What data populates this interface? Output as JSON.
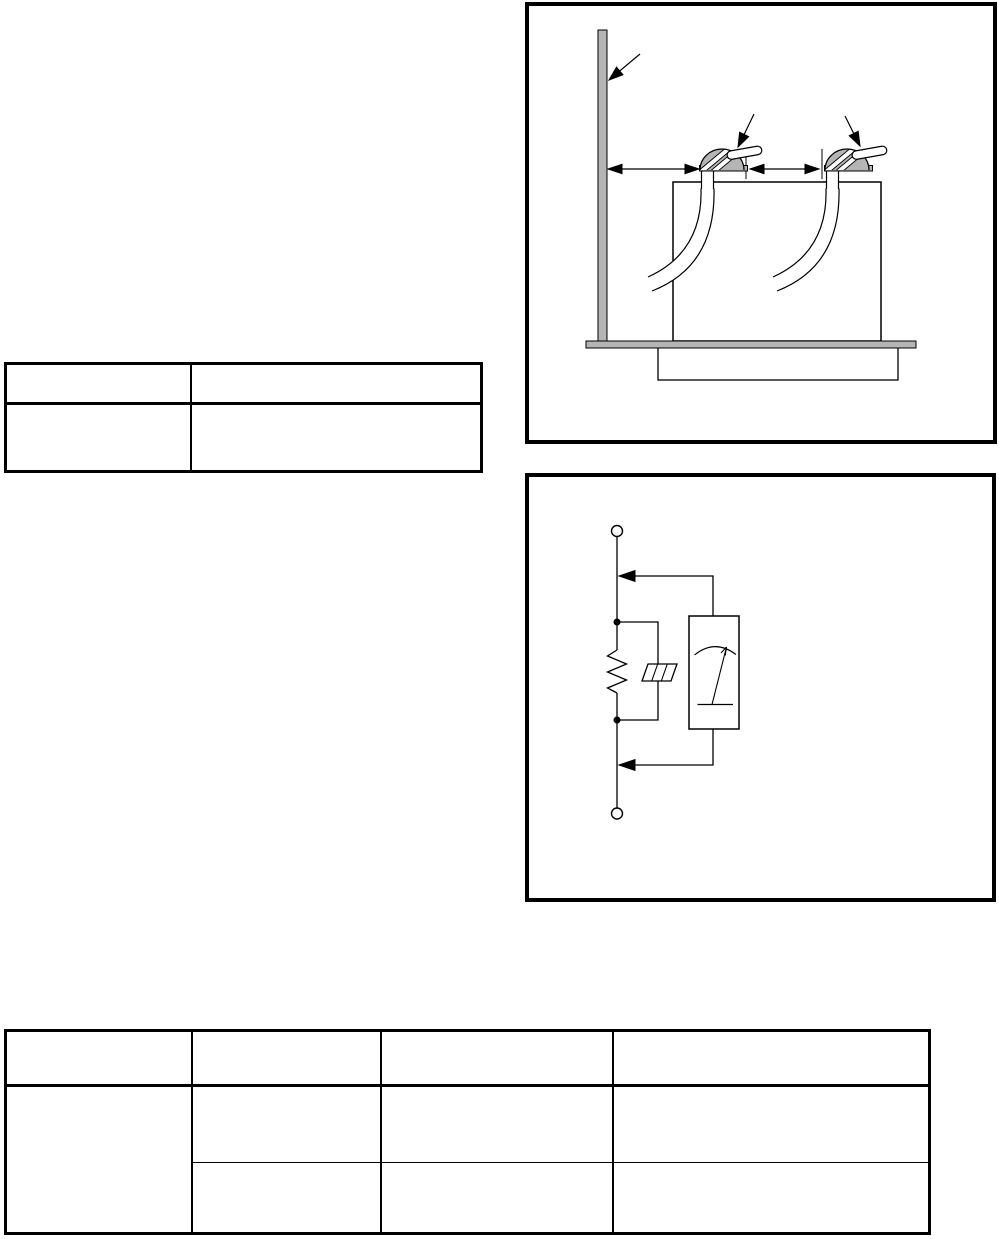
{
  "page": {
    "background_color": "#ffffff",
    "line_color": "#000000",
    "shade_color": "#b5b5b5"
  },
  "installation_diagram": {
    "figure": "unit-installation-clearance-diagram",
    "parts": [
      "wall",
      "unit-body",
      "base-plate",
      "pedestal",
      "left-nozzle",
      "right-nozzle",
      "left-tube",
      "right-tube"
    ],
    "annotations": [
      "wall-pointer-arrow",
      "left-nozzle-pointer-arrow",
      "right-nozzle-pointer-arrow",
      "wall-clearance-dimension-arrow",
      "nozzle-spacing-dimension-arrow",
      "dimension-tick"
    ]
  },
  "circuit_diagram": {
    "figure": "resistance-measurement-circuit",
    "parts": [
      "top-terminal",
      "bottom-terminal",
      "main-wire",
      "resistor",
      "protector-element",
      "parallel-branch",
      "meter"
    ],
    "annotations": [
      "top-lead-arrow",
      "bottom-lead-arrow"
    ]
  },
  "upper_table": {
    "rows": [
      [
        "",
        ""
      ],
      [
        "",
        ""
      ]
    ]
  },
  "lower_table": {
    "header": [
      "",
      "",
      "",
      ""
    ],
    "merged_cell": "",
    "rows": [
      [
        "",
        "",
        ""
      ],
      [
        "",
        "",
        ""
      ]
    ]
  }
}
